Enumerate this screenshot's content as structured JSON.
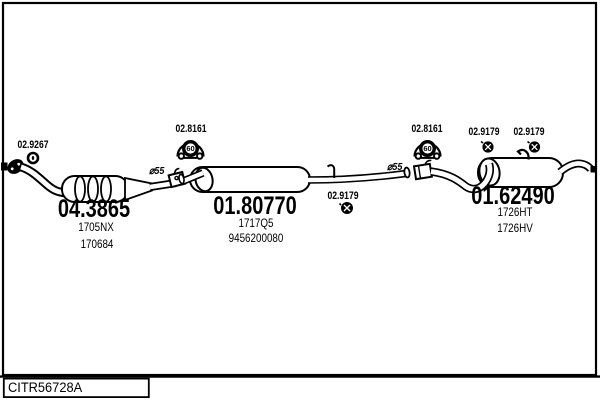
{
  "diagram": {
    "drawing_code": "CITR56728A",
    "front_gasket": {
      "code": "02.9267"
    },
    "catalyst": {
      "part_number": "04.3865",
      "ref1": "1705NX",
      "ref2": "170684"
    },
    "diameter_front": "⌀55",
    "diameter_rear": "⌀55",
    "clamp_front": {
      "code": "02.8161",
      "size": "60"
    },
    "clamp_rear": {
      "code": "02.8161",
      "size": "60"
    },
    "middle_muffler": {
      "part_number": "01.80770",
      "ref1": "1717Q5",
      "ref2": "9456200080"
    },
    "mount_middle": {
      "code": "02.9179"
    },
    "mount_rear_1": {
      "code": "02.9179"
    },
    "mount_rear_2": {
      "code": "02.9179"
    },
    "rear_muffler": {
      "part_number": "01.62490",
      "ref1": "1726HT",
      "ref2": "1726HV"
    }
  }
}
